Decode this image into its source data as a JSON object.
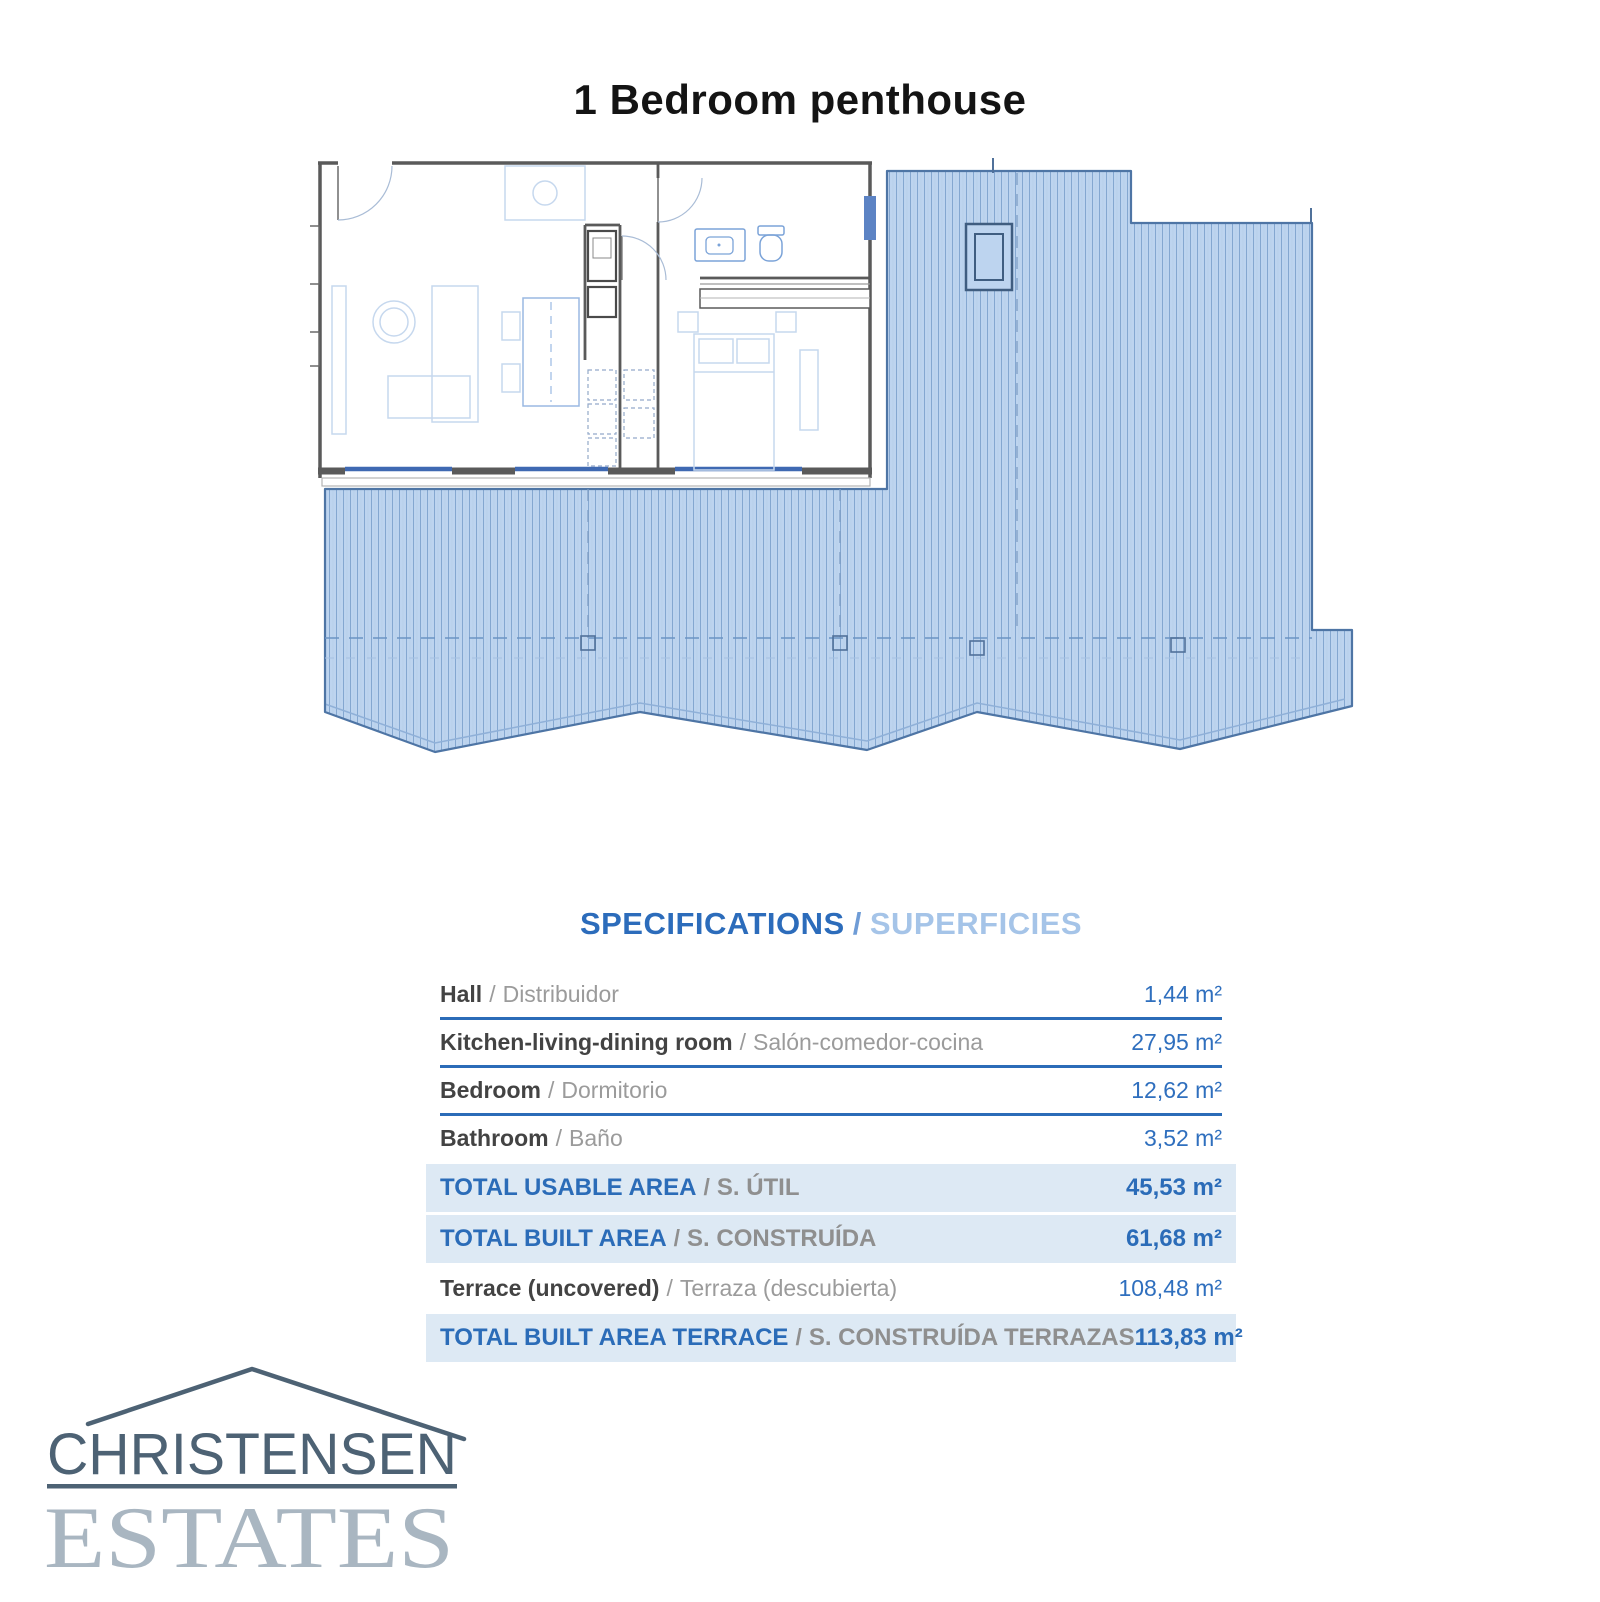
{
  "page": {
    "title": "1 Bedroom penthouse"
  },
  "specifications": {
    "heading_en": "SPECIFICATIONS",
    "separator": "/",
    "heading_es": "SUPERFICIES",
    "rows": [
      {
        "label_en": "Hall",
        "label_es": "Distribuidor",
        "value": "1,44 m²"
      },
      {
        "label_en": "Kitchen-living-dining room",
        "label_es": "Salón-comedor-cocina",
        "value": "27,95 m²"
      },
      {
        "label_en": "Bedroom",
        "label_es": "Dormitorio",
        "value": "12,62 m²"
      },
      {
        "label_en": "Bathroom",
        "label_es": "Baño",
        "value": "3,52 m²"
      },
      {
        "label_en": "TOTAL USABLE AREA",
        "label_es": "S. ÚTIL",
        "value": "45,53 m²"
      },
      {
        "label_en": "TOTAL BUILT AREA",
        "label_es": "S. CONSTRUÍDA",
        "value": "61,68 m²"
      },
      {
        "label_en": "Terrace (uncovered)",
        "label_es": "Terraza (descubierta)",
        "value": "108,48 m²"
      },
      {
        "label_en": "TOTAL BUILT AREA TERRACE",
        "label_es": "S. CONSTRUÍDA TERRAZAS",
        "value": "113,83 m²"
      }
    ]
  },
  "logo": {
    "line1": "CHRISTENSEN",
    "line2": "ESTATES"
  },
  "colors": {
    "accent_blue": "#2b6cb8",
    "heading_light_blue": "#a5c4e8",
    "row_highlight": "#dde9f4",
    "terrace_fill": "#bdd4ef",
    "terrace_outline": "#4e75a5",
    "plan_wall_gray": "#5a5a5a",
    "window_blue": "#3f69b2",
    "logo_dark": "#4d6274",
    "logo_light": "#a9b6c1"
  }
}
